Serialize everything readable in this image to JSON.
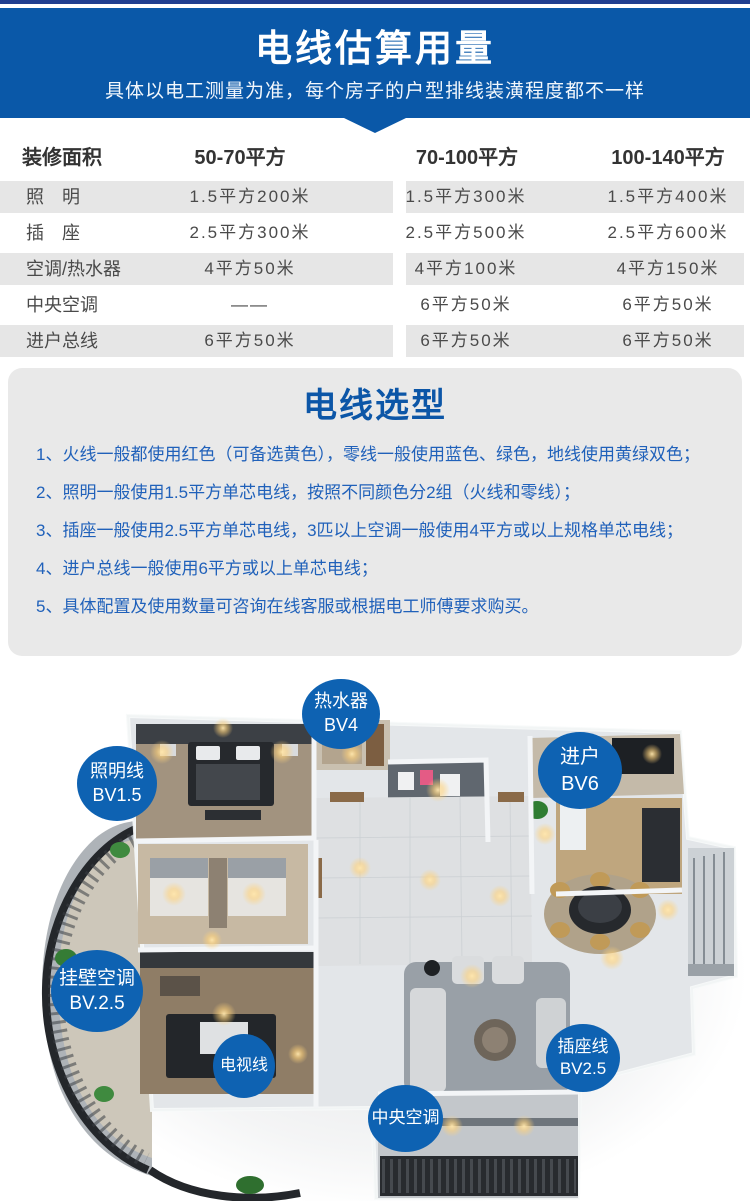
{
  "header": {
    "title": "电线估算用量",
    "subtitle": "具体以电工测量为准，每个房子的户型排线装潢程度都不一样"
  },
  "table": {
    "area_header": "装修面积",
    "col_headers": [
      "50-70平方",
      "70-100平方",
      "100-140平方"
    ],
    "rows": [
      {
        "label": "照　明",
        "v1": "1.5平方200米",
        "v2": "1.5平方300米",
        "v3": "1.5平方400米"
      },
      {
        "label": "插　座",
        "v1": "2.5平方300米",
        "v2": "2.5平方500米",
        "v3": "2.5平方600米"
      },
      {
        "label": "空调/热水器",
        "v1": "4平方50米",
        "v2": "4平方100米",
        "v3": "4平方150米"
      },
      {
        "label": "中央空调",
        "v1": "——",
        "v2": "6平方50米",
        "v3": "6平方50米"
      },
      {
        "label": "进户总线",
        "v1": "6平方50米",
        "v2": "6平方50米",
        "v3": "6平方50米"
      }
    ]
  },
  "chart_data": {
    "type": "table",
    "title": "电线估算用量",
    "columns": [
      "装修面积",
      "50-70平方",
      "70-100平方",
      "100-140平方"
    ],
    "rows": [
      [
        "照明",
        "1.5平方200米",
        "1.5平方300米",
        "1.5平方400米"
      ],
      [
        "插座",
        "2.5平方300米",
        "2.5平方500米",
        "2.5平方600米"
      ],
      [
        "空调/热水器",
        "4平方50米",
        "4平方100米",
        "4平方150米"
      ],
      [
        "中央空调",
        "——",
        "6平方50米",
        "6平方50米"
      ],
      [
        "进户总线",
        "6平方50米",
        "6平方50米",
        "6平方50米"
      ]
    ]
  },
  "selection": {
    "title": "电线选型",
    "items": [
      "1、火线一般都使用红色（可备选黄色），零线一般使用蓝色、绿色，地线使用黄绿双色；",
      "2、照明一般使用1.5平方单芯电线，按照不同颜色分2组（火线和零线）；",
      "3、插座一般使用2.5平方单芯电线，3匹以上空调一般使用4平方或以上规格单芯电线；",
      "4、进户总线一般使用6平方或以上单芯电线；",
      "5、具体配置及使用数量可咨询在线客服或根据电工师傅要求购买。"
    ]
  },
  "floorplan": {
    "labels": {
      "water_heater": {
        "line1": "热水器",
        "line2": "BV4"
      },
      "entry": {
        "line1": "进户",
        "line2": "BV6"
      },
      "lighting": {
        "line1": "照明线",
        "line2": "BV1.5"
      },
      "wall_ac": {
        "line1": "挂壁空调",
        "line2": "BV.2.5"
      },
      "tv": {
        "line1": "电视线",
        "line2": null
      },
      "socket": {
        "line1": "插座线",
        "line2": "BV2.5"
      },
      "central_ac": {
        "line1": "中央空调",
        "line2": null
      }
    }
  },
  "colors": {
    "header_blue": "#0a58a8",
    "top_strip_navy": "#213f90",
    "stripe_gray": "#e6e6e6",
    "panel_gray": "#e9e9e9",
    "selection_title_blue": "#0c56a7",
    "selection_text_blue": "#2061ba",
    "label_circle_blue": "#0e62b2",
    "table_text": "#4a4a4a"
  }
}
